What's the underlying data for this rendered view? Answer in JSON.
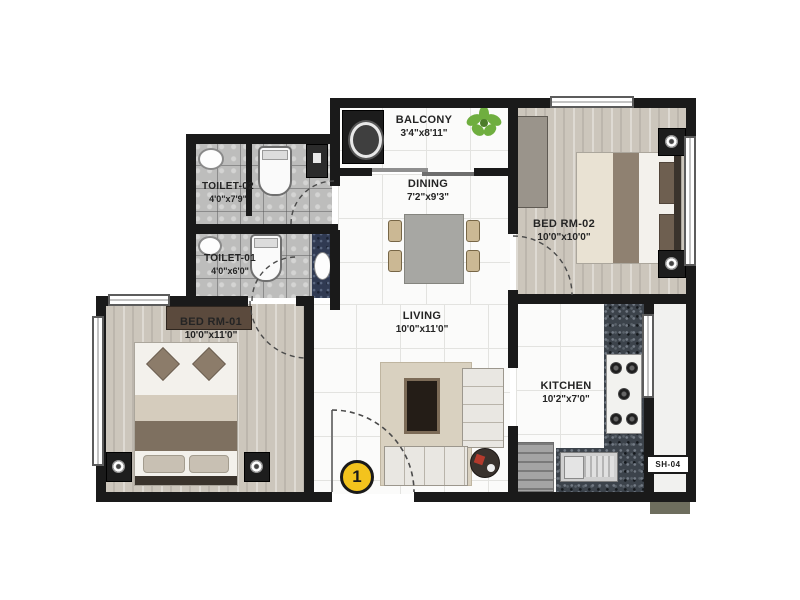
{
  "plan": {
    "title": "2BHK apartment floor plan",
    "rooms": [
      {
        "name": "BALCONY",
        "dims": "3'4\"x8'11\""
      },
      {
        "name": "DINING",
        "dims": "7'2\"x9'3\""
      },
      {
        "name": "TOILET-02",
        "dims": "4'0\"x7'9\""
      },
      {
        "name": "TOILET-01",
        "dims": "4'0\"x6'0\""
      },
      {
        "name": "BED RM-01",
        "dims": "10'0\"x11'0\""
      },
      {
        "name": "BED RM-02",
        "dims": "10'0\"x10'0\""
      },
      {
        "name": "LIVING",
        "dims": "10'0\"x11'0\""
      },
      {
        "name": "KITCHEN",
        "dims": "10'2\"x7'0\""
      }
    ],
    "entrance": {
      "marker": "1"
    },
    "shaft": {
      "label": "SH-04"
    },
    "colors": {
      "wall": "#1a1a1a",
      "entrance_marker": "#f3c31d",
      "plant_green": "#6fae3f",
      "granite": "#3c434b",
      "wood_floor": "#ccc6bc",
      "rug": "#d9d1c0",
      "navy_counter": "#303a52"
    }
  }
}
